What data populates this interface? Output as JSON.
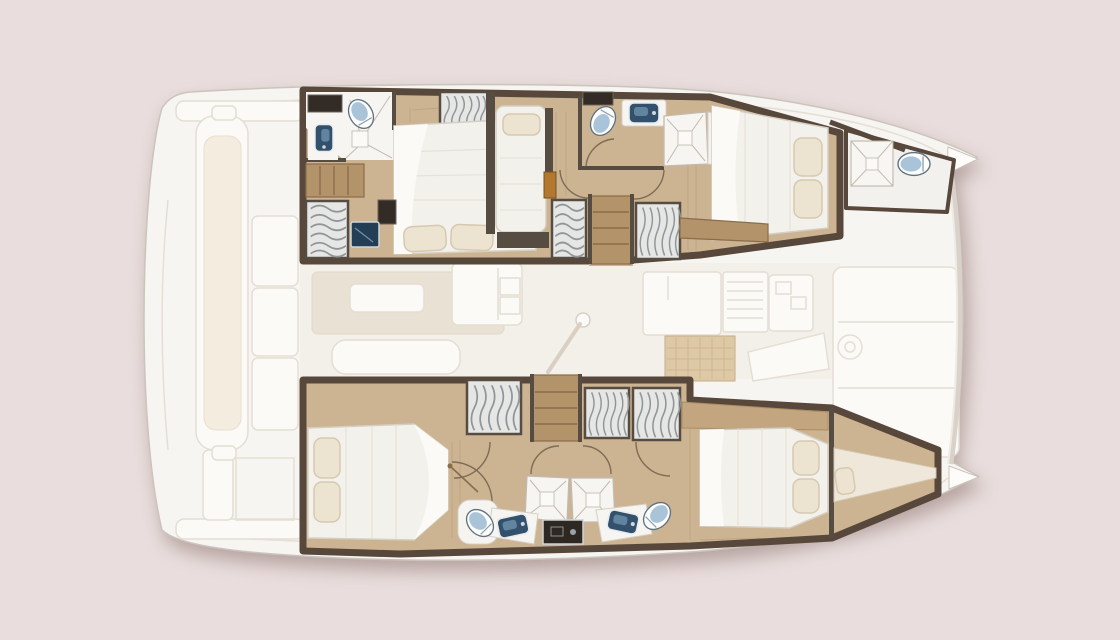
{
  "window": {
    "width": 1120,
    "height": 640
  },
  "image": {
    "type": "yacht-floor-plan",
    "description": "Top-down interior layout plan of a cruising catamaran, bow pointing right; hull accommodations rendered vividly, exterior decks and saloon ghosted in white",
    "bow_direction": "right"
  },
  "colors": {
    "background": "#e9dedd",
    "background_edge": "#dccfce",
    "hull_ghost": "#f7f5f2",
    "hull_line": "#cbc4bc",
    "deck_line": "#e4ded6",
    "ghost_furniture": "#fbfaf7",
    "ghost_furniture_line": "#e5ded3",
    "ghost_cushion": "#f3ecdf",
    "saloon_floor": "#f3efe9",
    "table_beige": "#e9e1d3",
    "wall_dark": "#574c41",
    "wall_black": "#332c26",
    "wood_floor": "#ccb391",
    "wood_plank_line": "#b59a74",
    "wood_step": "#b3946a",
    "wood_step_line": "#8a6c49",
    "headboard_wood": "#c3a67f",
    "white_fixture": "#f7f5f1",
    "fixture_line": "#c2bab0",
    "mattress": "#f3f1ec",
    "mattress_line": "#d5cec2",
    "mattress_stripe": "#e7e2d9",
    "sheet_fold": "#fbfaf6",
    "pillow": "#ece3d1",
    "pillow_line": "#d6c9af",
    "wardrobe_fill": "#e6e7e5",
    "wardrobe_line": "#8f969a",
    "sink_navy": "#33516c",
    "sink_navy_light": "#6e92ad",
    "toilet_lid": "#a9c4d8",
    "toilet_line": "#5f7280",
    "door_arc": "#7d6c56",
    "door_amber": "#b3782f",
    "mat_fill": "#dec9a7",
    "mat_line": "#c7ae87",
    "tv_navy": "#243f55"
  },
  "plan": {
    "vessel": "catamaran",
    "view": "top-down deck plan",
    "port_hull": {
      "aft_bathroom": [
        "toilet",
        "sink",
        "shower"
      ],
      "aft_cabin": "double-bed",
      "midship": [
        "single-berth",
        "stairs",
        "wardrobes",
        "tv-locker"
      ],
      "forward_bathroom": [
        "toilet",
        "sink",
        "shower"
      ],
      "forward_cabin": "double-bed",
      "forepeak": [
        "deck-hatch",
        "toilet"
      ]
    },
    "starboard_hull": {
      "aft_cabin": "double-bed",
      "vanity": [
        "door-swing",
        "seat"
      ],
      "midship": [
        "wardrobes",
        "companionway-steps",
        "two-showers",
        "two-sinks",
        "two-toilets",
        "dark-cabinet"
      ],
      "forward_cabin": "double-bed",
      "bow_berth": "v-berth-cushion"
    },
    "ghosted_deck": [
      "aft-cockpit-bench",
      "transom-steps",
      "davit-bar",
      "saloon-table",
      "sofa",
      "fridge",
      "galley-counters",
      "galley-mat",
      "mast-base",
      "foredeck-panels",
      "bow-tips",
      "forward-crossbeam"
    ]
  }
}
